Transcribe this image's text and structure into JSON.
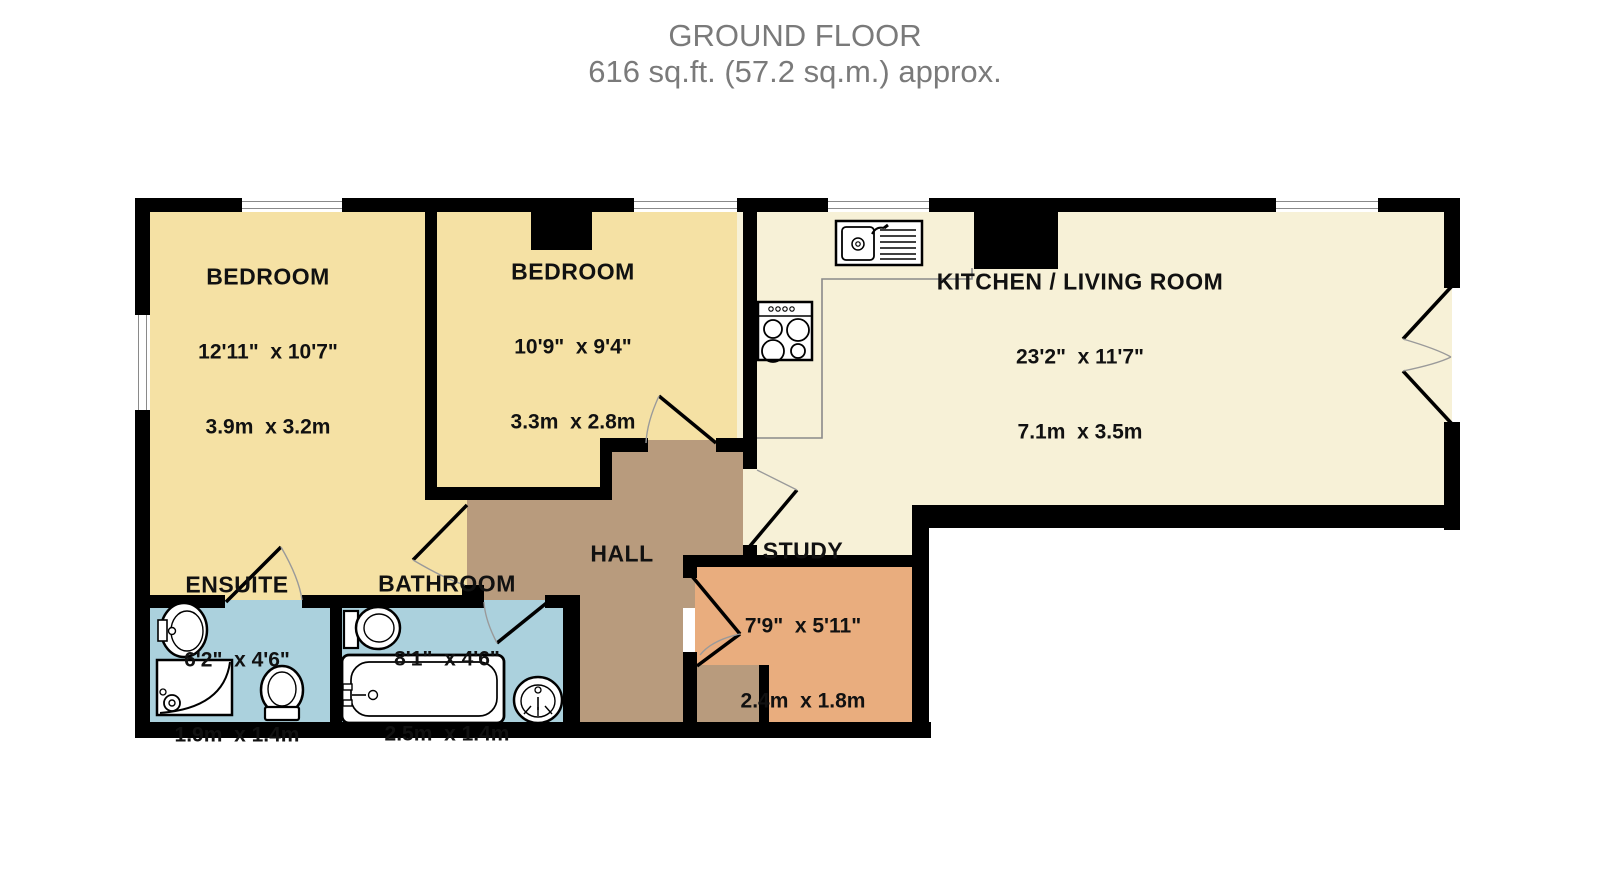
{
  "title": {
    "line1": "GROUND FLOOR",
    "line2": "616 sq.ft. (57.2 sq.m.) approx."
  },
  "rooms": [
    {
      "id": "bedroom-1",
      "name": "BEDROOM",
      "dims_imperial": "12'11\"  x 10'7\"",
      "dims_metric": "3.9m  x 3.2m"
    },
    {
      "id": "bedroom-2",
      "name": "BEDROOM",
      "dims_imperial": "10'9\"  x 9'4\"",
      "dims_metric": "3.3m  x 2.8m"
    },
    {
      "id": "kitchen-living-room",
      "name": "KITCHEN / LIVING ROOM",
      "dims_imperial": "23'2\"  x 11'7\"",
      "dims_metric": "7.1m  x 3.5m"
    },
    {
      "id": "hall",
      "name": "HALL"
    },
    {
      "id": "study",
      "name": "STUDY",
      "dims_imperial": "7'9\"  x 5'11\"",
      "dims_metric": "2.4m  x 1.8m"
    },
    {
      "id": "ensuite",
      "name": "ENSUITE",
      "dims_imperial": "6'2\"  x 4'6\"",
      "dims_metric": "1.9m  x 1.4m"
    },
    {
      "id": "bathroom",
      "name": "BATHROOM",
      "dims_imperial": "8'1\"  x 4'6\"",
      "dims_metric": "2.5m  x 1.4m"
    }
  ],
  "colors": {
    "bedroom_fill": "#f5e1a4",
    "kitchen_fill": "#f7f1d7",
    "hall_fill": "#b89b7d",
    "study_fill": "#e9ad7e",
    "bathroom_fill": "#abd1dd",
    "wall": "#000000",
    "title_text": "#7a7a7a"
  },
  "fixtures": [
    "kitchen-sink",
    "stove-hob",
    "ensuite-sink",
    "shower",
    "ensuite-toilet",
    "bathroom-toilet",
    "bathtub",
    "bathroom-sink"
  ]
}
